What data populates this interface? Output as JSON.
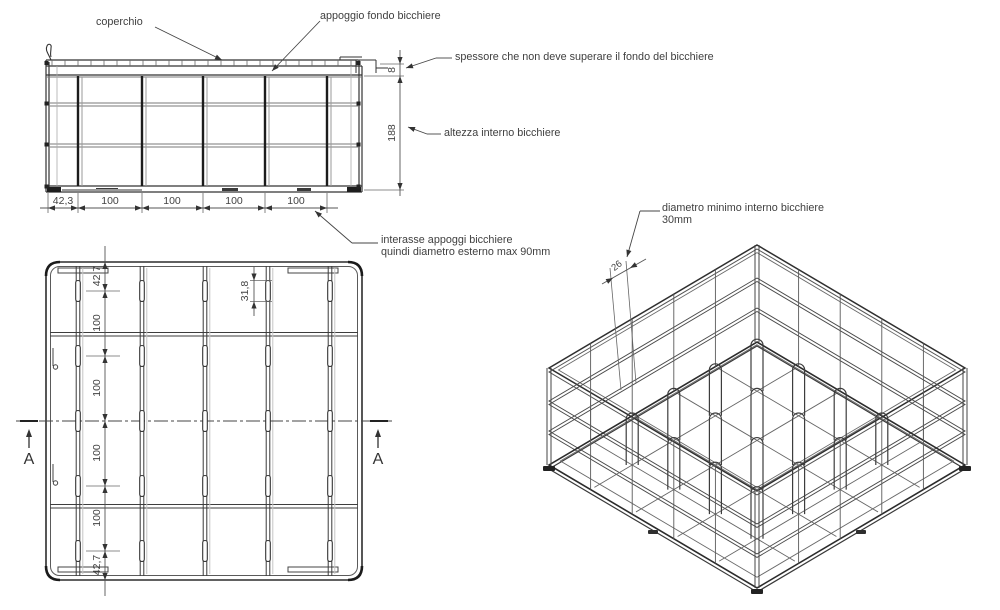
{
  "drawing": {
    "labels": {
      "coperchio": "coperchio",
      "appoggio": "appoggio fondo bicchiere",
      "spessore": "spessore che non deve superare il fondo del bicchiere",
      "altezza": "altezza interno bicchiere",
      "interasse_1": "interasse appoggi bicchiere",
      "interasse_2": "quindi diametro esterno max 90mm",
      "diametro_1": "diametro minimo interno bicchiere",
      "diametro_2": "30mm"
    },
    "front": {
      "dims_bottom": [
        "42,3",
        "100",
        "100",
        "100",
        "100"
      ],
      "dim_thickness": "8",
      "dim_height": "188"
    },
    "top": {
      "dims_left": [
        "42,7",
        "100",
        "100",
        "100",
        "100",
        "42,7"
      ],
      "dim_slot": "31,8",
      "section_a": "A"
    },
    "iso": {
      "dim_loop": "26"
    },
    "colors": {
      "line_dark": "#2d2d2d",
      "line_mid": "#555555",
      "line_light": "#999999",
      "text": "#3f3f3f"
    }
  }
}
